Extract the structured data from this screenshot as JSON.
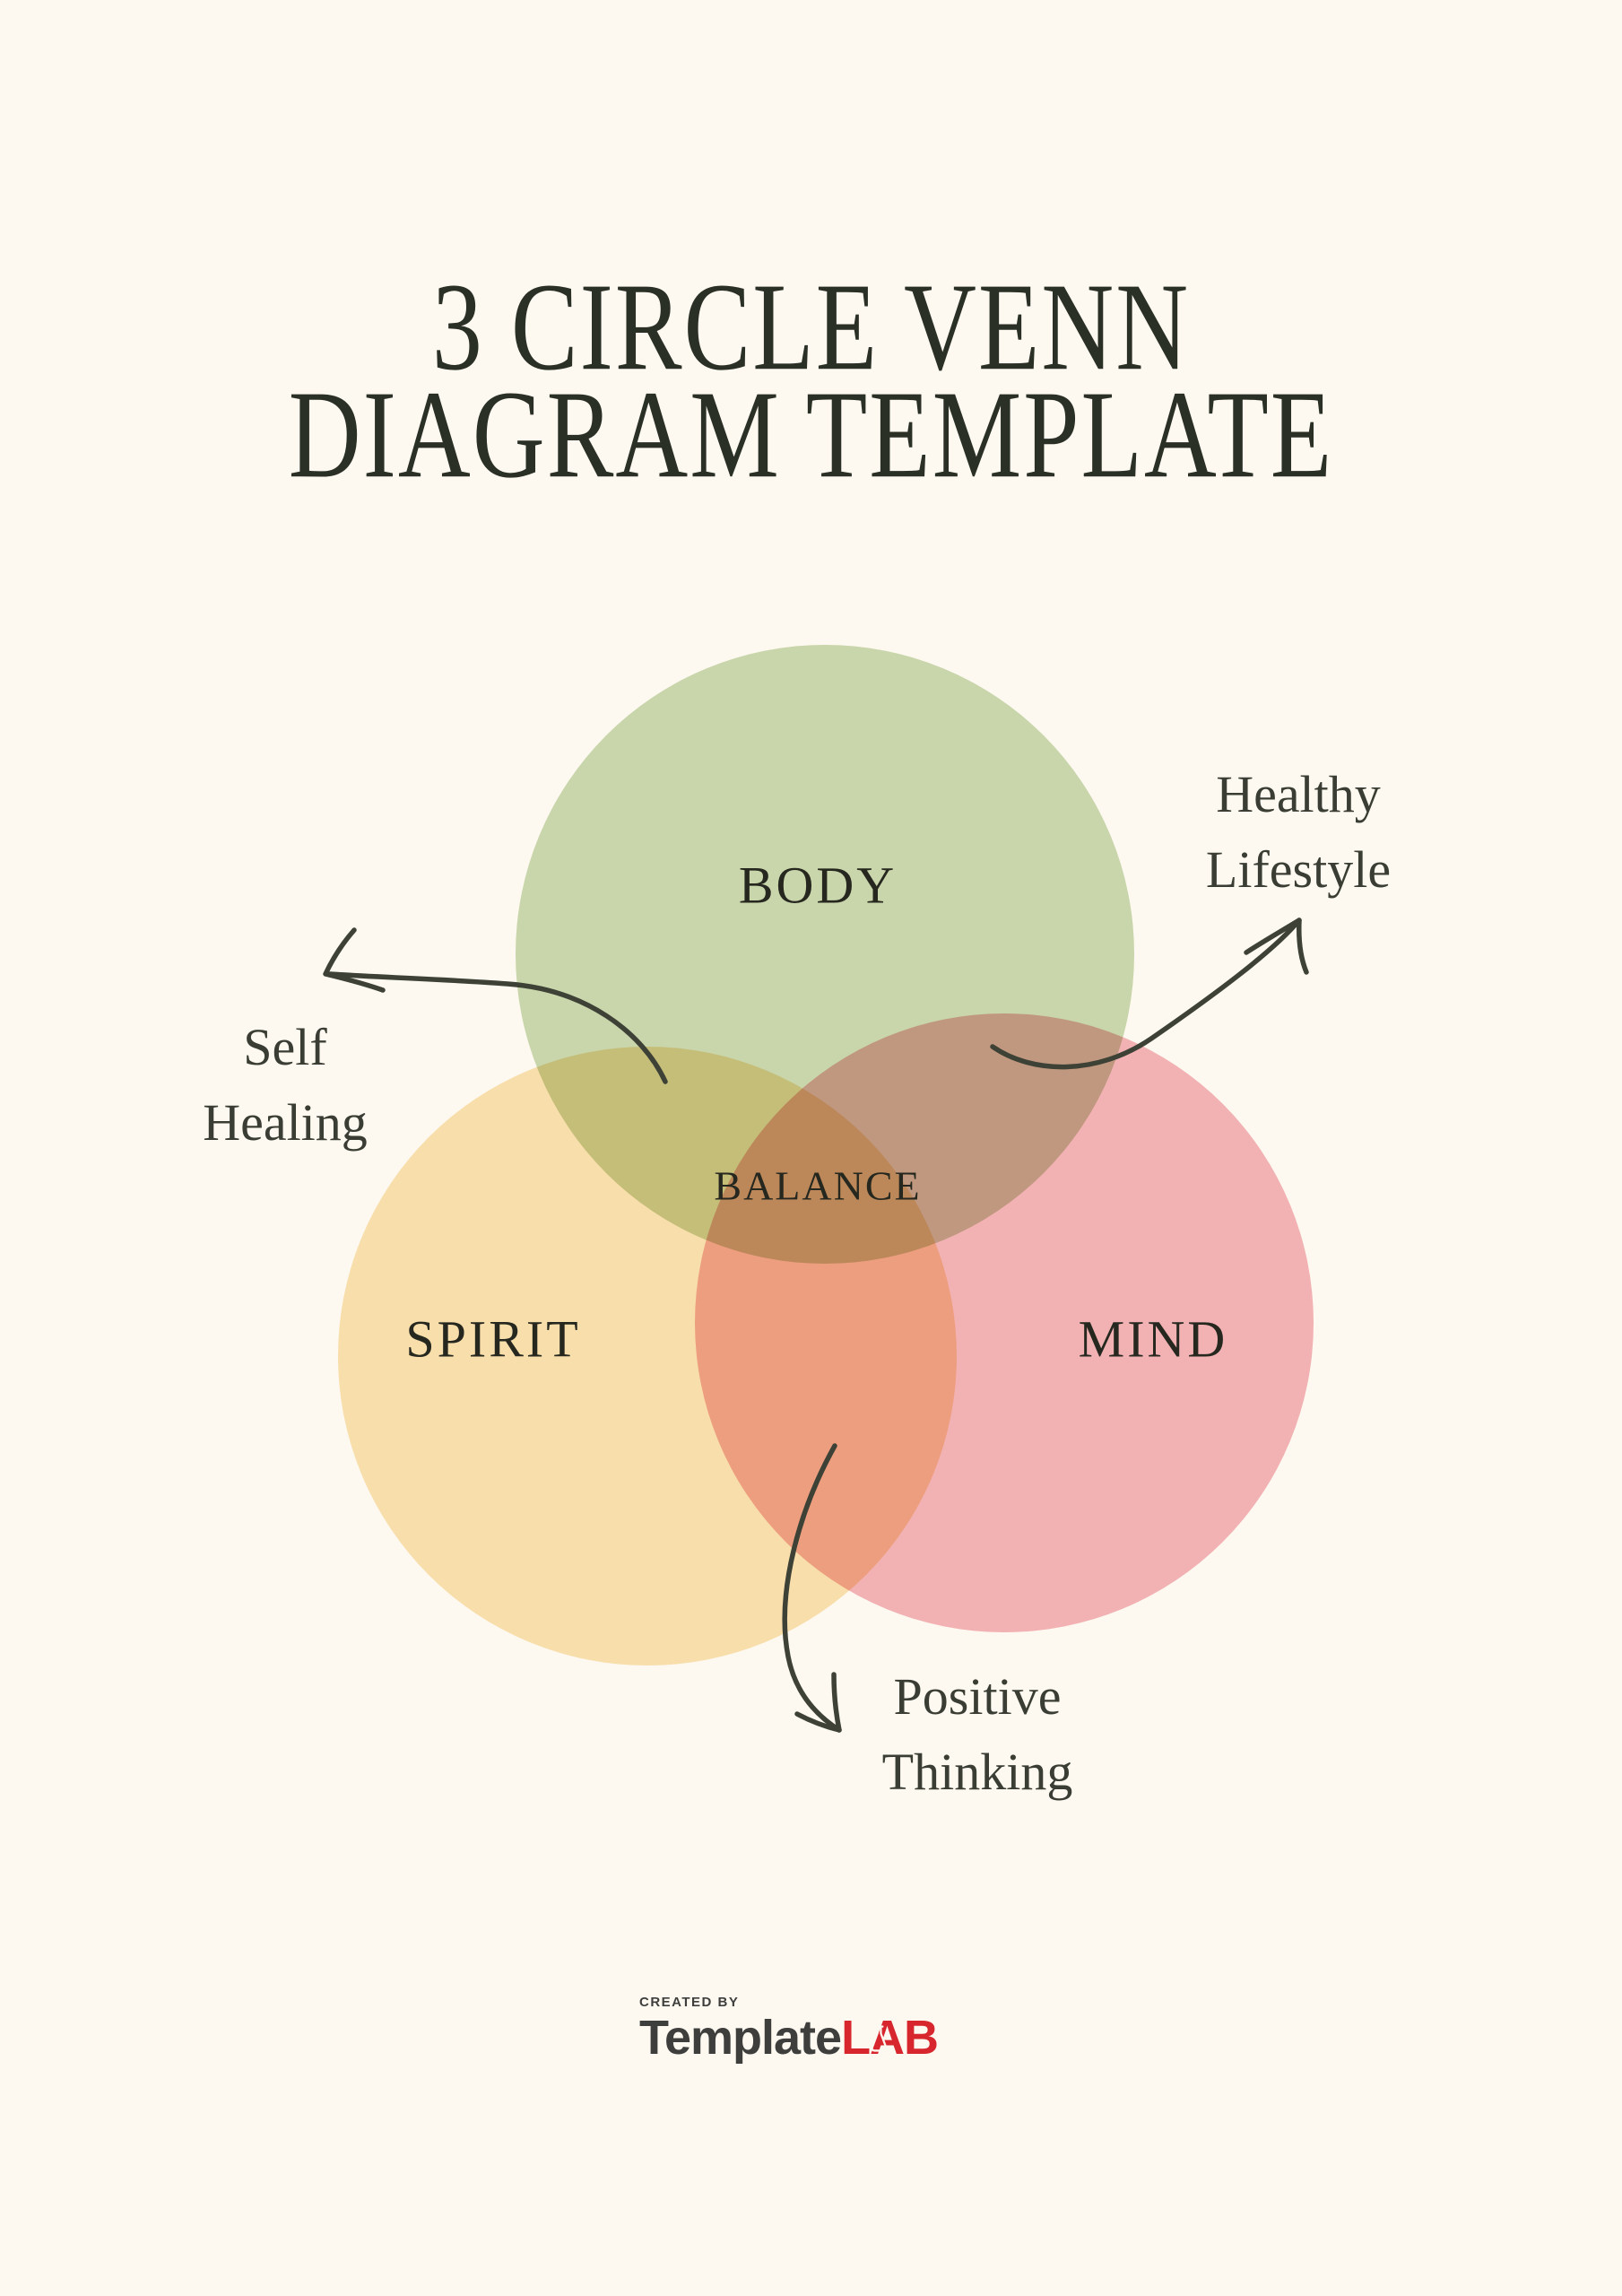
{
  "page": {
    "background": "#FDF9F0"
  },
  "title": {
    "line1": "3 CIRCLE VENN",
    "line2": "DIAGRAM TEMPLATE",
    "color": "#2B3026"
  },
  "venn": {
    "type": "venn-3-circle",
    "circles": [
      {
        "id": "body",
        "label": "BODY",
        "color": "#CBDAB5"
      },
      {
        "id": "spirit",
        "label": "SPIRIT",
        "color": "#FAE4B6"
      },
      {
        "id": "mind",
        "label": "MIND",
        "color": "#F4B6BE"
      }
    ],
    "center_label": "BALANCE",
    "label_color": "#26281F"
  },
  "annotations": {
    "color": "#3A3D33",
    "healthy_lifestyle": {
      "line1": "Healthy",
      "line2": "Lifestyle"
    },
    "self_healing": {
      "line1": "Self",
      "line2": "Healing"
    },
    "positive_thinking": {
      "line1": "Positive",
      "line2": "Thinking"
    }
  },
  "arrows": {
    "color": "#3D4136"
  },
  "footer": {
    "created_by": "CREATED BY",
    "brand_primary": "Template",
    "brand_accent": "LAB",
    "primary_color": "#3E3E3D",
    "accent_color": "#D7262D"
  }
}
